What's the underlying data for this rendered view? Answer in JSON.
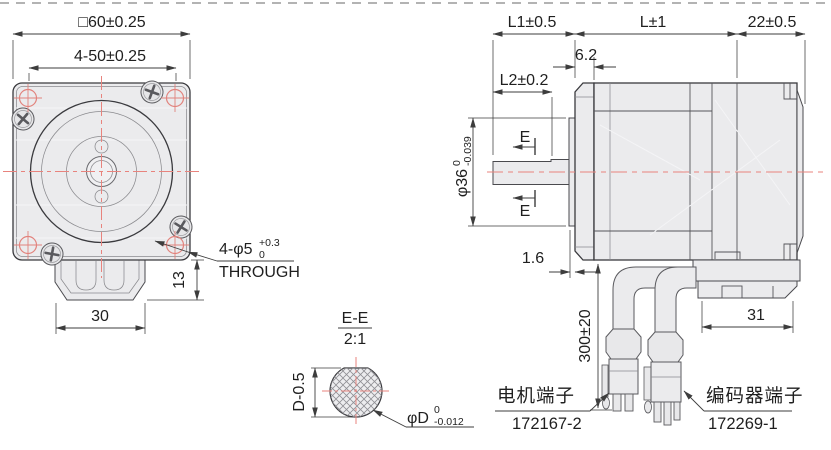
{
  "front": {
    "dim_square": "□60±0.25",
    "dim_hole_pitch": "4-50±0.25",
    "dim_tab_height": "13",
    "dim_tab_width": "30",
    "hole_note": "4-φ5",
    "hole_note_tol_upper": "+0.3",
    "hole_note_tol_lower": "0",
    "hole_note_line2": "THROUGH"
  },
  "side": {
    "dim_shaft_len": "L1±0.5",
    "dim_body_len": "L±1",
    "dim_rear_len": "22±0.5",
    "dim_flange_offset": "6.2",
    "dim_flat_len": "L2±0.2",
    "dim_pilot": "φ36",
    "dim_pilot_tol_upper": "0",
    "dim_pilot_tol_lower": "-0.039",
    "dim_boss_height": "1.6",
    "dim_cable_len": "300±20",
    "dim_conn_width": "31",
    "section_mark_top": "E",
    "section_mark_bottom": "E",
    "motor_terminal_label": "电机端子",
    "motor_terminal_part": "172167-2",
    "encoder_terminal_label": "编码器端子",
    "encoder_terminal_part": "172269-1"
  },
  "section": {
    "title": "E-E",
    "scale": "2:1",
    "dim_flat": "D-0.5",
    "dim_dia": "φD",
    "dim_dia_tol_upper": "0",
    "dim_dia_tol_lower": "-0.012"
  },
  "colors": {
    "centerline": "#e8837d",
    "outline": "#3a3a3e",
    "metal_fill": "#ebebed",
    "dim_line": "#3d3d3d"
  }
}
